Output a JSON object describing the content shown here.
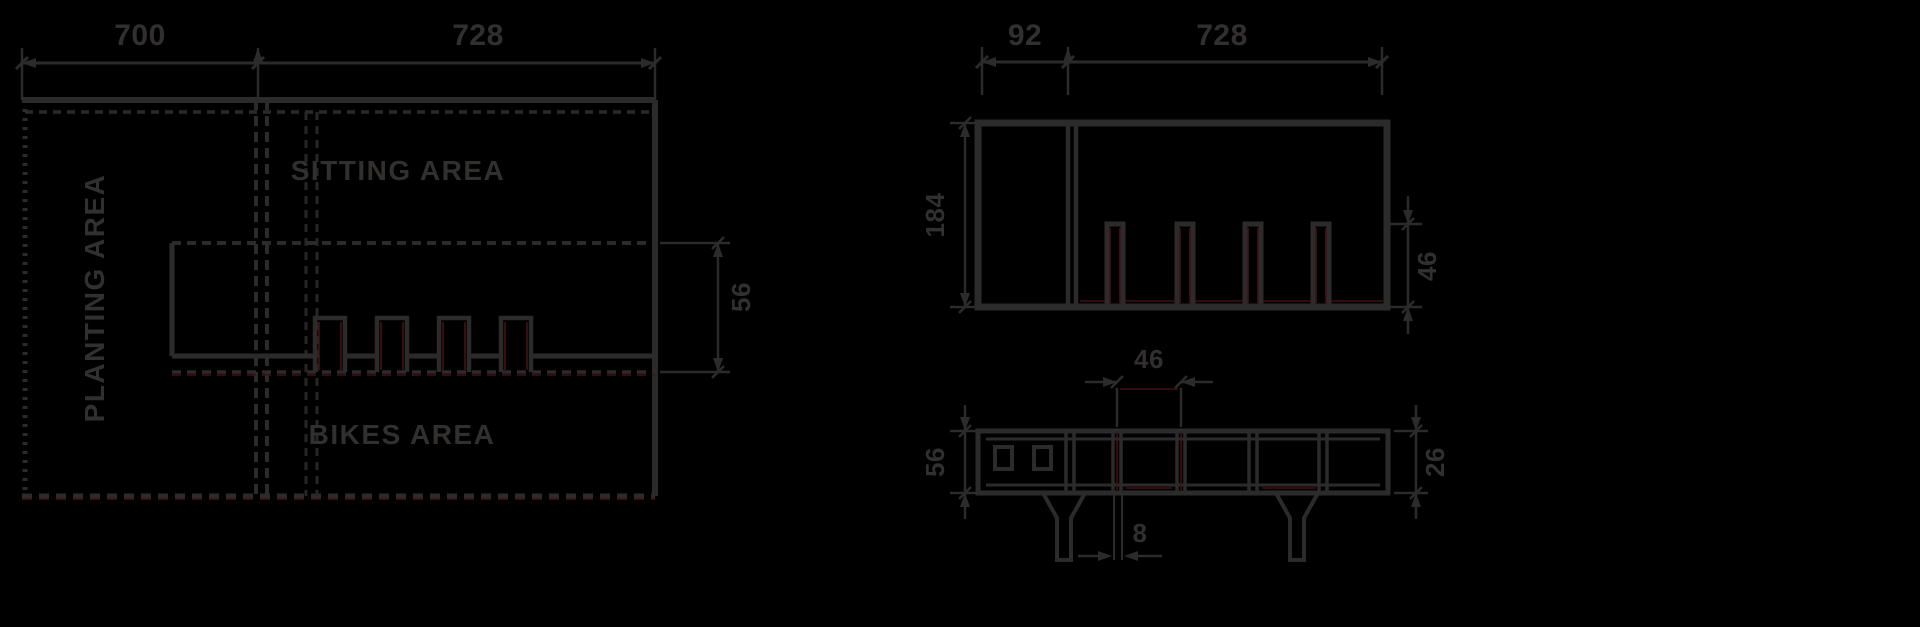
{
  "figure_type": "technical-dimension-drawing",
  "colors": {
    "background": "#000000",
    "line": "#2b2b2b",
    "accent_red": "#461114",
    "text": "#322f2f"
  },
  "plan_view": {
    "dim_width_left": "700",
    "dim_width_right": "728",
    "dim_band_height": "56",
    "area_planting": "PLANTING AREA",
    "area_sitting": "SITTING AREA",
    "area_bikes": "BIKES AREA"
  },
  "front_view": {
    "dim_top_small": "92",
    "dim_top_large": "728",
    "dim_height": "184",
    "dim_slot_height": "46"
  },
  "side_view": {
    "dim_panel_width": "46",
    "dim_height": "56",
    "dim_profile_height": "26",
    "dim_wall_thickness": "8"
  }
}
